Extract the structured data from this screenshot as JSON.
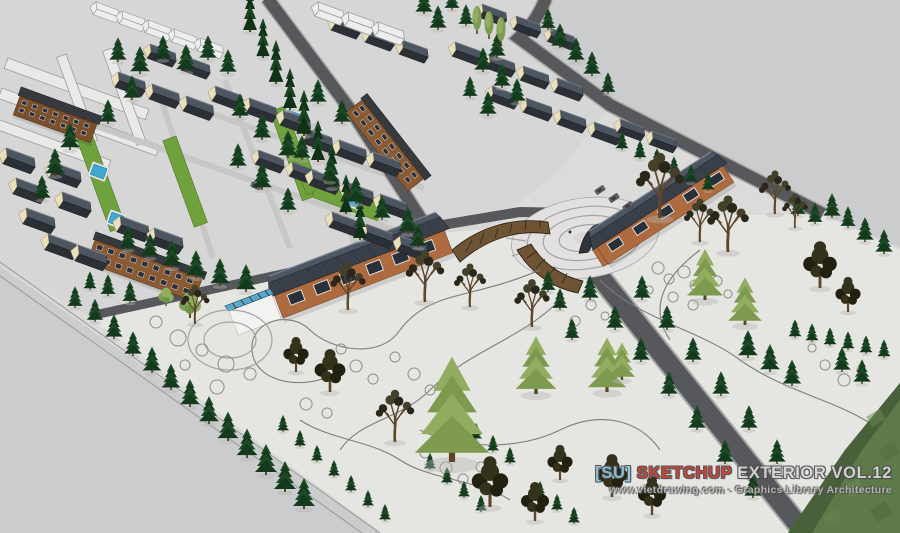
{
  "watermark": {
    "line1_parts": [
      {
        "text": "[SU]",
        "color": "#8cc6df"
      },
      {
        "text": "SKETCHUP",
        "color": "#c4382d"
      },
      {
        "text": "EXTERIOR VOL.12",
        "color": "#d9d9d7"
      }
    ],
    "line2": "www.vietdrawing.com - Graphics Library Architecture"
  },
  "palette": {
    "background": "#cbcccd",
    "site_ground": "#dbdbd9",
    "estate_ground": "#d5d6d5",
    "park_ground": "#e5e5e2",
    "road": "#56585b",
    "roof_dark": "#2b3036",
    "roof_blue_gray": "#3a4049",
    "wall_brick": "#ad6b3f",
    "wall_cream": "#eadfbc",
    "brown_building": "#8a5a33",
    "lawn": "#6fa13c",
    "pool_water": "#3fa9cf",
    "pine_dark": "#1d4a26",
    "pine_light": "#93ad60",
    "terrain_grass": "#5e7a4a",
    "path_line": "#7d7d7b"
  },
  "scene": {
    "trees": [
      [
        "c",
        250,
        32,
        1
      ],
      [
        "c",
        263,
        58,
        0.95
      ],
      [
        "c",
        276,
        84,
        1.05
      ],
      [
        "c",
        290,
        110,
        1
      ],
      [
        "c",
        304,
        136,
        1.1
      ],
      [
        "c",
        318,
        162,
        1
      ],
      [
        "c",
        332,
        188,
        1.05
      ],
      [
        "c",
        346,
        214,
        0.95
      ],
      [
        "c",
        360,
        240,
        1
      ],
      [
        "p",
        118,
        62,
        0.8
      ],
      [
        "p",
        140,
        74,
        0.9
      ],
      [
        "p",
        163,
        60,
        0.8
      ],
      [
        "p",
        186,
        72,
        0.9
      ],
      [
        "p",
        208,
        60,
        0.8
      ],
      [
        "p",
        228,
        74,
        0.8
      ],
      [
        "p",
        70,
        150,
        0.9
      ],
      [
        "p",
        55,
        176,
        0.9
      ],
      [
        "p",
        42,
        200,
        0.8
      ],
      [
        "p",
        132,
        100,
        0.8
      ],
      [
        "p",
        108,
        124,
        0.8
      ],
      [
        "p",
        240,
        118,
        0.8
      ],
      [
        "p",
        262,
        140,
        0.85
      ],
      [
        "p",
        288,
        158,
        0.9
      ],
      [
        "p",
        238,
        168,
        0.8
      ],
      [
        "p",
        262,
        190,
        0.9
      ],
      [
        "p",
        288,
        212,
        0.8
      ],
      [
        "p",
        318,
        104,
        0.8
      ],
      [
        "p",
        342,
        124,
        0.8
      ],
      [
        "p",
        302,
        160,
        0.8
      ],
      [
        "p",
        330,
        182,
        0.8
      ],
      [
        "p",
        356,
        204,
        0.9
      ],
      [
        "p",
        382,
        220,
        0.8
      ],
      [
        "p",
        408,
        234,
        0.9
      ],
      [
        "p",
        418,
        248,
        0.8
      ],
      [
        "p",
        172,
        268,
        0.9
      ],
      [
        "p",
        196,
        278,
        0.9
      ],
      [
        "p",
        220,
        286,
        0.9
      ],
      [
        "p",
        246,
        292,
        0.9
      ],
      [
        "p",
        128,
        250,
        0.8
      ],
      [
        "p",
        150,
        258,
        0.8
      ],
      [
        "p",
        424,
        14,
        0.8
      ],
      [
        "p",
        438,
        30,
        0.8
      ],
      [
        "p",
        452,
        10,
        0.7
      ],
      [
        "p",
        466,
        26,
        0.7
      ],
      [
        "p",
        497,
        58,
        0.8
      ],
      [
        "p",
        483,
        72,
        0.8
      ],
      [
        "p",
        502,
        88,
        0.8
      ],
      [
        "p",
        517,
        103,
        0.8
      ],
      [
        "p",
        470,
        98,
        0.7
      ],
      [
        "p",
        488,
        116,
        0.8
      ],
      [
        "p",
        560,
        48,
        0.8
      ],
      [
        "p",
        576,
        62,
        0.8
      ],
      [
        "p",
        592,
        76,
        0.8
      ],
      [
        "p",
        548,
        30,
        0.7
      ],
      [
        "p",
        608,
        94,
        0.7
      ],
      [
        "s",
        622,
        150,
        0.6
      ],
      [
        "s",
        640,
        159,
        0.6
      ],
      [
        "s",
        657,
        167,
        0.6
      ],
      [
        "s",
        674,
        175,
        0.6
      ],
      [
        "s",
        691,
        183,
        0.6
      ],
      [
        "s",
        708,
        191,
        0.6
      ],
      [
        "p",
        798,
        216,
        0.7
      ],
      [
        "p",
        815,
        224,
        0.7
      ],
      [
        "p",
        832,
        218,
        0.8
      ],
      [
        "p",
        848,
        228,
        0.7
      ],
      [
        "p",
        865,
        242,
        0.8
      ],
      [
        "p",
        884,
        254,
        0.8
      ],
      [
        "s",
        795,
        338,
        0.6
      ],
      [
        "s",
        812,
        342,
        0.6
      ],
      [
        "s",
        830,
        346,
        0.6
      ],
      [
        "s",
        848,
        350,
        0.6
      ],
      [
        "s",
        866,
        354,
        0.6
      ],
      [
        "s",
        884,
        358,
        0.6
      ],
      [
        "p",
        748,
        358,
        0.9
      ],
      [
        "p",
        770,
        372,
        0.9
      ],
      [
        "p",
        792,
        386,
        0.85
      ],
      [
        "p",
        842,
        372,
        0.8
      ],
      [
        "p",
        862,
        384,
        0.8
      ],
      [
        "p",
        590,
        300,
        0.8
      ],
      [
        "p",
        615,
        330,
        0.8
      ],
      [
        "p",
        641,
        362,
        0.8
      ],
      [
        "p",
        669,
        396,
        0.8
      ],
      [
        "p",
        697,
        430,
        0.8
      ],
      [
        "p",
        725,
        464,
        0.8
      ],
      [
        "p",
        753,
        498,
        0.8
      ],
      [
        "p",
        642,
        300,
        0.8
      ],
      [
        "p",
        667,
        330,
        0.8
      ],
      [
        "p",
        693,
        362,
        0.8
      ],
      [
        "p",
        721,
        396,
        0.8
      ],
      [
        "p",
        749,
        430,
        0.8
      ],
      [
        "p",
        777,
        464,
        0.8
      ],
      [
        "p",
        560,
        310,
        0.7
      ],
      [
        "p",
        548,
        292,
        0.7
      ],
      [
        "p",
        572,
        340,
        0.7
      ],
      [
        "s",
        283,
        432,
        0.55
      ],
      [
        "s",
        300,
        447,
        0.55
      ],
      [
        "s",
        317,
        462,
        0.55
      ],
      [
        "s",
        334,
        477,
        0.55
      ],
      [
        "s",
        351,
        492,
        0.55
      ],
      [
        "s",
        368,
        507,
        0.55
      ],
      [
        "s",
        385,
        521,
        0.55
      ],
      [
        "s",
        430,
        470,
        0.55
      ],
      [
        "s",
        447,
        484,
        0.55
      ],
      [
        "s",
        464,
        498,
        0.55
      ],
      [
        "s",
        481,
        512,
        0.55
      ],
      [
        "s",
        476,
        440,
        0.55
      ],
      [
        "s",
        493,
        452,
        0.55
      ],
      [
        "s",
        510,
        464,
        0.55
      ],
      [
        "s",
        540,
        498,
        0.55
      ],
      [
        "s",
        557,
        511,
        0.55
      ],
      [
        "s",
        574,
        524,
        0.55
      ],
      [
        "p",
        75,
        308,
        0.7
      ],
      [
        "p",
        95,
        322,
        0.75
      ],
      [
        "p",
        114,
        339,
        0.8
      ],
      [
        "p",
        133,
        356,
        0.8
      ],
      [
        "p",
        152,
        373,
        0.85
      ],
      [
        "p",
        171,
        390,
        0.85
      ],
      [
        "p",
        190,
        407,
        0.9
      ],
      [
        "p",
        209,
        424,
        0.9
      ],
      [
        "p",
        228,
        441,
        0.95
      ],
      [
        "p",
        247,
        458,
        0.95
      ],
      [
        "p",
        266,
        475,
        1
      ],
      [
        "p",
        285,
        492,
        1
      ],
      [
        "p",
        304,
        509,
        1
      ],
      [
        "p",
        108,
        296,
        0.7
      ],
      [
        "p",
        130,
        303,
        0.7
      ],
      [
        "p",
        90,
        290,
        0.6
      ],
      [
        "l",
        452,
        462,
        3.1
      ],
      [
        "l",
        536,
        394,
        1.7
      ],
      [
        "l",
        607,
        392,
        1.6
      ],
      [
        "l",
        705,
        300,
        1.5
      ],
      [
        "l",
        745,
        325,
        1.4
      ],
      [
        "l",
        622,
        380,
        1.1
      ],
      [
        "g",
        190,
        318,
        1
      ],
      [
        "g",
        166,
        306,
        0.7
      ],
      [
        "o",
        477,
        34,
        1
      ],
      [
        "o",
        489,
        39,
        1
      ],
      [
        "o",
        501,
        45,
        1
      ],
      [
        "b",
        348,
        310,
        1.1
      ],
      [
        "b",
        425,
        302,
        1.2
      ],
      [
        "b",
        470,
        307,
        1
      ],
      [
        "b",
        532,
        327,
        1.1
      ],
      [
        "b",
        660,
        218,
        1.5
      ],
      [
        "b",
        728,
        252,
        1.3
      ],
      [
        "b",
        775,
        214,
        1
      ],
      [
        "b",
        795,
        228,
        0.8
      ],
      [
        "b",
        700,
        242,
        1
      ],
      [
        "b",
        395,
        442,
        1.2
      ],
      [
        "b",
        195,
        324,
        0.9
      ],
      [
        "d",
        820,
        288,
        1.2
      ],
      [
        "d",
        848,
        312,
        0.9
      ],
      [
        "d",
        330,
        392,
        1.1
      ],
      [
        "d",
        296,
        372,
        0.9
      ],
      [
        "d",
        490,
        507,
        1.3
      ],
      [
        "d",
        535,
        521,
        1
      ],
      [
        "d",
        612,
        497,
        1.1
      ],
      [
        "d",
        560,
        480,
        0.9
      ],
      [
        "d",
        652,
        515,
        1
      ]
    ],
    "house_rows": [
      [
        6,
        148,
        3,
        10,
        30,
        1
      ],
      [
        52,
        162,
        2,
        10,
        30,
        1
      ],
      [
        48,
        234,
        2,
        30,
        11,
        1
      ],
      [
        120,
        216,
        2,
        34,
        12,
        1
      ],
      [
        118,
        72,
        3,
        34,
        12,
        0.95
      ],
      [
        150,
        44,
        2,
        34,
        12,
        0.9
      ],
      [
        215,
        86,
        3,
        34,
        12,
        0.95
      ],
      [
        258,
        150,
        2,
        34,
        12,
        0.9
      ],
      [
        305,
        128,
        3,
        34,
        12,
        0.95
      ],
      [
        312,
        170,
        3,
        34,
        12,
        0.95
      ],
      [
        332,
        212,
        3,
        34,
        12,
        0.95
      ],
      [
        455,
        42,
        4,
        34,
        12,
        0.9
      ],
      [
        492,
        86,
        4,
        34,
        12,
        0.9
      ],
      [
        620,
        119,
        2,
        32,
        12,
        0.85
      ],
      [
        334,
        16,
        3,
        34,
        12,
        0.9
      ],
      [
        482,
        4,
        3,
        34,
        12,
        0.85
      ]
    ],
    "wire_rows": [
      [
        96,
        2,
        5,
        26,
        9,
        0.8
      ],
      [
        318,
        2,
        3,
        30,
        10,
        0.9
      ]
    ],
    "lawns": [
      [
        92,
        134,
        98,
        16,
        70
      ],
      [
        176,
        136,
        92,
        14,
        70
      ],
      [
        285,
        106,
        95,
        16,
        70
      ],
      [
        308,
        158,
        34,
        14,
        70
      ],
      [
        318,
        180,
        70,
        18,
        20
      ]
    ],
    "pools": [
      [
        94,
        164,
        14,
        11,
        20
      ],
      [
        112,
        212,
        13,
        11,
        20
      ],
      [
        288,
        110,
        14,
        10,
        20
      ],
      [
        349,
        194,
        13,
        10,
        20
      ]
    ],
    "cars": [
      [
        600,
        190,
        -35
      ],
      [
        614,
        198,
        -35
      ],
      [
        628,
        206,
        -35
      ],
      [
        302,
        148,
        25
      ],
      [
        256,
        186,
        25
      ]
    ]
  }
}
